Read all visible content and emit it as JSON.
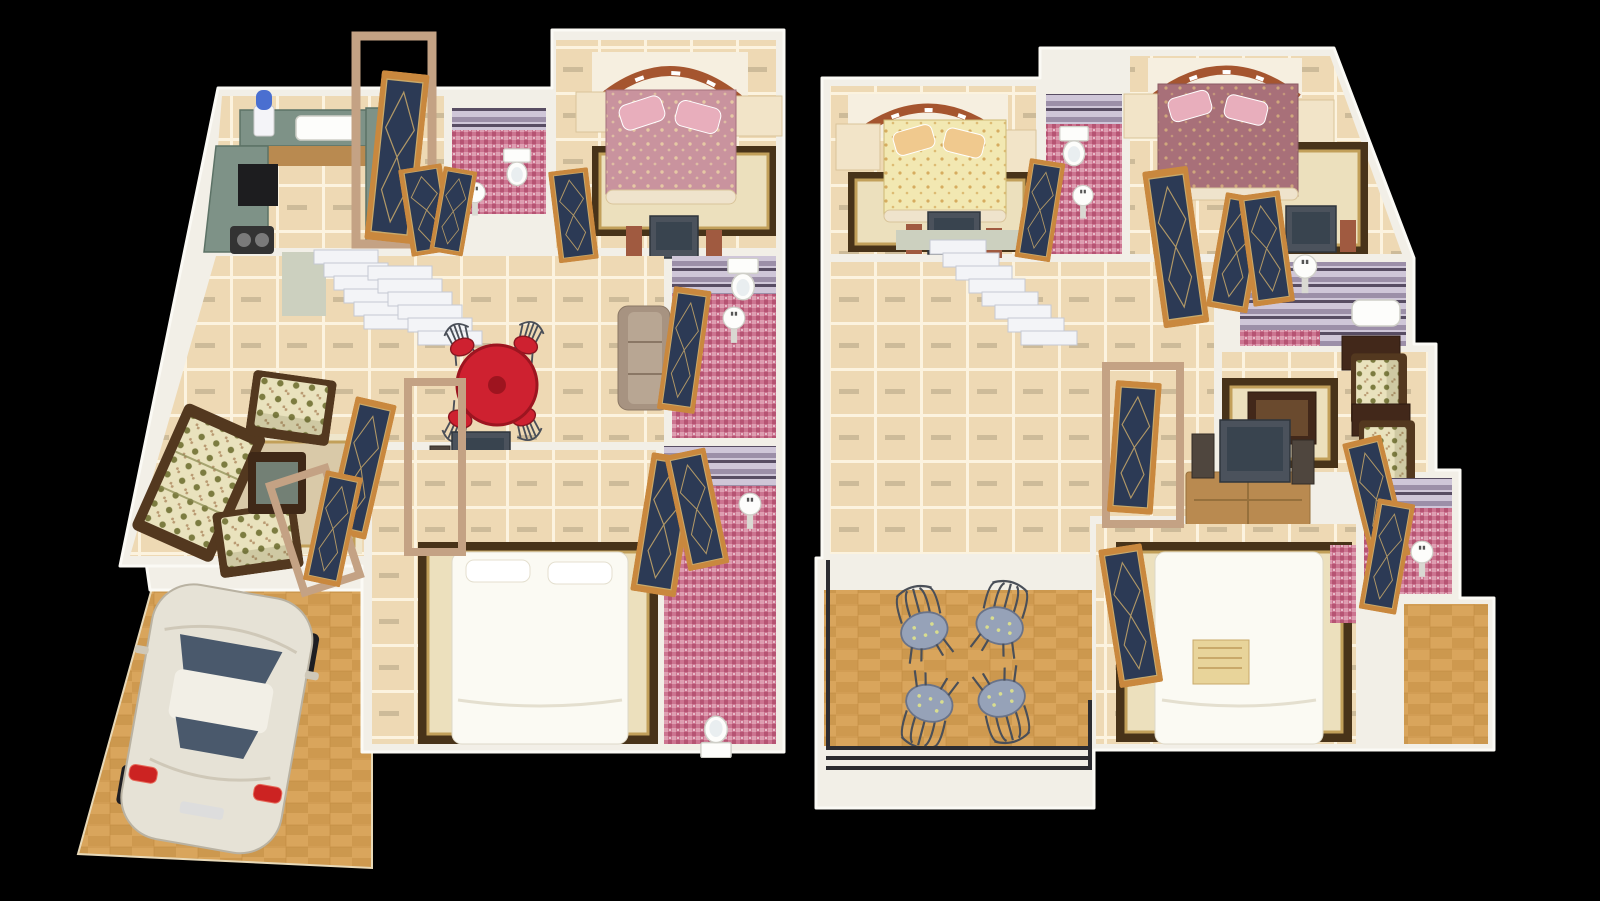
{
  "scene": {
    "kind": "3d-rendered-floor-plan",
    "background": "black",
    "units": [
      {
        "id": "ground-floor",
        "position": "left",
        "rooms": [
          "kitchen",
          "common-bathroom",
          "master-bedroom",
          "hall-with-staircase",
          "dining-area",
          "living-room",
          "second-bedroom",
          "attached-bathroom",
          "rear-bathroom",
          "car-porch"
        ],
        "furniture": [
          "l-shaped-granite-counter",
          "kitchen-sink",
          "stove",
          "gas-hob",
          "water-purifier",
          "pink-floral-double-bed",
          "bedside-cabinets",
          "ornate-rug",
          "tv-bench",
          "white-staircase",
          "red-round-dining-table",
          "four-wire-dining-chairs",
          "floral-sofa-set",
          "coffee-table",
          "tv-unit-with-speakers",
          "white-double-bed",
          "toilets",
          "pedestal-wash-basins",
          "wooden-glass-doors",
          "silver-sedan-car"
        ]
      },
      {
        "id": "first-floor",
        "position": "right",
        "rooms": [
          "bedroom-yellow",
          "common-bathroom",
          "bedroom-rose",
          "hall-with-staircase",
          "shower-bathroom",
          "sitting-nook",
          "bedroom-white",
          "attached-bathroom",
          "large-balcony",
          "small-balcony"
        ],
        "furniture": [
          "yellow-floral-double-bed",
          "rose-floral-double-bed",
          "white-double-bed",
          "bedside-cabinets",
          "ornate-rugs",
          "white-staircase",
          "tv-unit-with-speakers",
          "two-floral-armchairs",
          "dark-side-tables",
          "coffee-table",
          "toilet",
          "pedestal-wash-basins",
          "bath-tub",
          "wooden-glass-doors",
          "four-wire-balcony-chairs",
          "metal-railing"
        ]
      }
    ],
    "counts": {
      "beds": 5,
      "bathrooms": 6,
      "staircases": 2,
      "balcony_chairs": 4,
      "dining_chairs": 4,
      "cars": 1
    }
  },
  "palette": {
    "bg": "#000000",
    "wall": "#f2efe7",
    "wall-bright": "#fbfaf5",
    "wall-shade": "#ccd0bf",
    "floor": "#eed9b4",
    "grout": "#fcf3df",
    "tile-dash": "#b3a183",
    "parquet": "#d9a55c",
    "parquet-dark": "#bb8336",
    "mosaic-pink": "#cc7490",
    "mosaic-pink-dark": "#b34f6f",
    "mosaic-pink-light": "#e2a6b7",
    "purple-wall": "#9c8fa8",
    "purple-wall-light": "#cfc6d8",
    "purple-wall-dark": "#584d63",
    "door-wood": "#c9883e",
    "door-glass": "#2c3a55",
    "door-gold": "#c9a96a",
    "frame-tan": "#c4a284",
    "granite": "#7e9287",
    "granite-dark": "#5c7266",
    "cabinet-wood": "#b98a50",
    "stair": "#f3f4f7",
    "stair-side": "#c5c9d3",
    "rug-cream": "#ece0bd",
    "rug-border": "#483319",
    "rug-gold": "#c2a05a",
    "bed-white": "#fbfaf3",
    "bed-pink": "#c9939e",
    "bed-yellow": "#f2e8b2",
    "bed-rose": "#a87079",
    "pillow-pink": "#e8aebc",
    "pillow-cream": "#f0c98e",
    "arch-brown": "#a5552f",
    "sofa-floral": "#e9e2bd",
    "sofa-dot": "#7c7c40",
    "sofa-wood": "#53381f",
    "tv-dark": "#4b525c",
    "tv-screen": "#39444f",
    "table-red": "#ce2130",
    "chair-metal": "#4a4f58",
    "seat-blue": "#96a2b8",
    "car-body": "#e6e2d6",
    "car-glass": "#4a596c",
    "tail-red": "#cc2322",
    "rail-dark": "#2c2c30"
  }
}
